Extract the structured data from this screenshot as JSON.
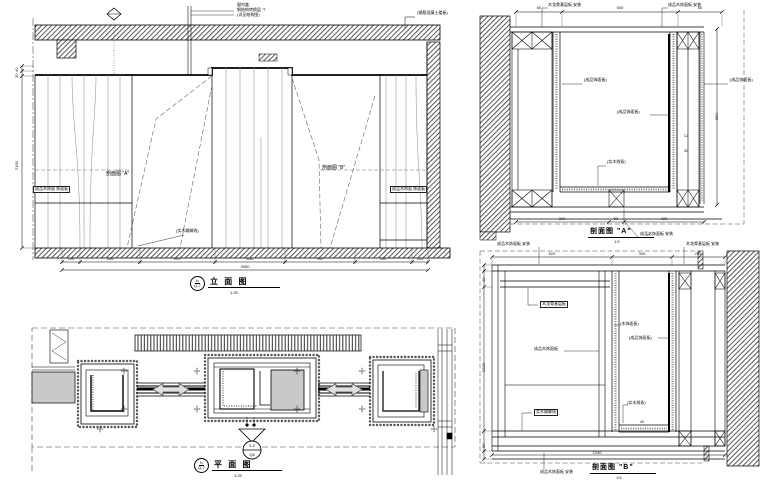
{
  "elevation": {
    "title": "立 面 图",
    "scale_note": "1:25",
    "ref_circle_top": "b",
    "ref_circle_bottom": "Q-7",
    "callout_top_lines": [
      "窗帘盒",
      "钢结构转换层 'T'",
      "(详见结构图)"
    ],
    "callout_slab": "(钢筋混凝土楼板)",
    "section_ref_a": "剖面图 \"A\"",
    "section_ref_b": "剖面图 \"B\"",
    "material_tag_left": "成品木饰面 饰面板",
    "material_tag_right": "成品木饰面 饰面板",
    "skirting_label": "(实木踢脚线)",
    "dims_bottom": [
      "100",
      "350",
      "900",
      "850",
      "900",
      "350",
      "100"
    ],
    "dim_bottom_total": "3550",
    "dims_left": [
      "40",
      "30",
      "2300"
    ]
  },
  "plan": {
    "title": "平 面 图",
    "scale_note": "1:25",
    "ref_circle_top": "b",
    "ref_circle_bottom": "Q-7",
    "marker_top": "2-2",
    "marker_bottom": "Q6"
  },
  "section_a": {
    "title": "剖面图 \"A\"",
    "scale_note": "1:5",
    "callout_top_left": "木龙骨基层板 安装",
    "callout_top_right": "成品木饰面板 安装",
    "label_left": "(成品饰面板)",
    "label_center": "(成品饰面板)",
    "label_right": "(成品饰面板)",
    "label_bottom": "(实木线条)",
    "callout_bottom": "成品木饰面板 安装",
    "dims_top": [
      "60",
      "600",
      "60"
    ],
    "dim_right": "850",
    "dims_bottom": [
      "300",
      "60",
      "320"
    ],
    "dims_small": [
      "12",
      "40"
    ]
  },
  "section_b": {
    "title": "剖面图 \"B\"",
    "scale_note": "1:5",
    "callout_top_left": "成品木饰面板 安装",
    "callout_top_right": "木龙骨基层板 安装",
    "tag_frame": "木龙骨基层板",
    "tag_panel": "成品木饰面板",
    "tag_skirting": "实木踢脚线",
    "label_ch1": "(木饰面板)",
    "label_ch2": "(成品饰面板)",
    "label_ch3": "(实木线条)",
    "callout_bottom": "成品木饰面板 安装",
    "dims_top": [
      "620",
      "300",
      "260"
    ],
    "dims_left": [
      "40",
      "2230",
      "60"
    ],
    "dim_bottom_total": "1240",
    "dim_small": "40"
  }
}
